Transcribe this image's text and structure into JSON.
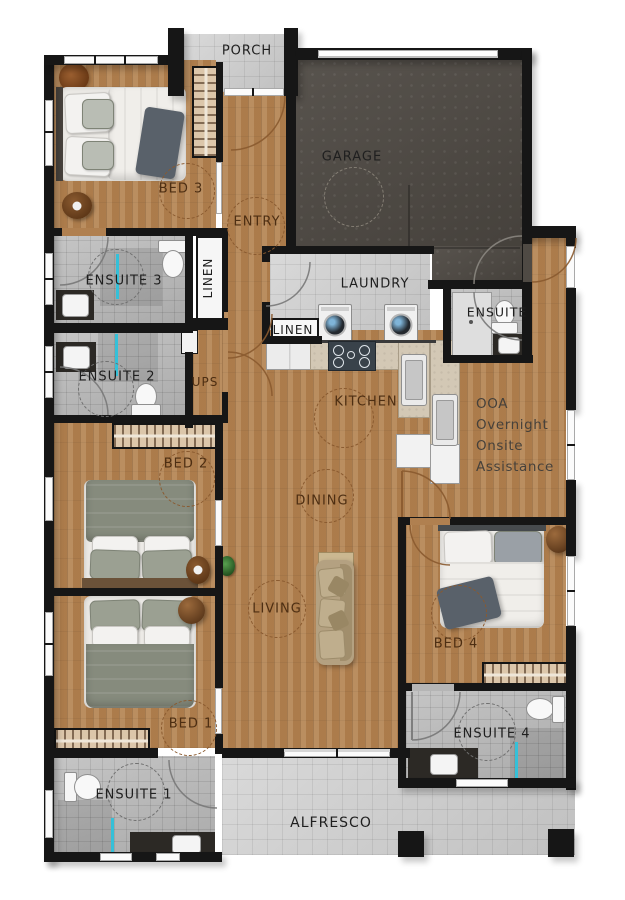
{
  "plan_title": "single-storey house floor plan",
  "rooms": {
    "porch": "PORCH",
    "garage": "GARAGE",
    "bed3": "BED 3",
    "entry": "ENTRY",
    "ensuite3": "ENSUITE 3",
    "linen_tall": "LINEN",
    "laundry": "LAUNDRY",
    "linen_small": "LINEN",
    "ensuite_mid": "ENSUITE",
    "ensuite2": "ENSUITE 2",
    "ups": "UPS",
    "kitchen": "KITCHEN",
    "bed2": "BED 2",
    "dining": "DINING",
    "living": "LIVING",
    "bed1": "BED 1",
    "bed4": "BED 4",
    "ensuite1": "ENSUITE 1",
    "ensuite4": "ENSUITE 4",
    "alfresco": "ALFRESCO"
  },
  "annotation": {
    "ooa_note": "OOA\nOvernight\nOnsite\nAssistance"
  },
  "colors": {
    "wall": "#161616",
    "wood_floor": "#b08050",
    "outdoor_tile": "#cbcbcb",
    "ensuite_tile": "#b5b5b5",
    "garage_floor": "#4f4a44",
    "label_on_wood": "#4d2e12",
    "label_on_tile": "#1f1f1f",
    "shower_glass": "#35c0d8"
  }
}
